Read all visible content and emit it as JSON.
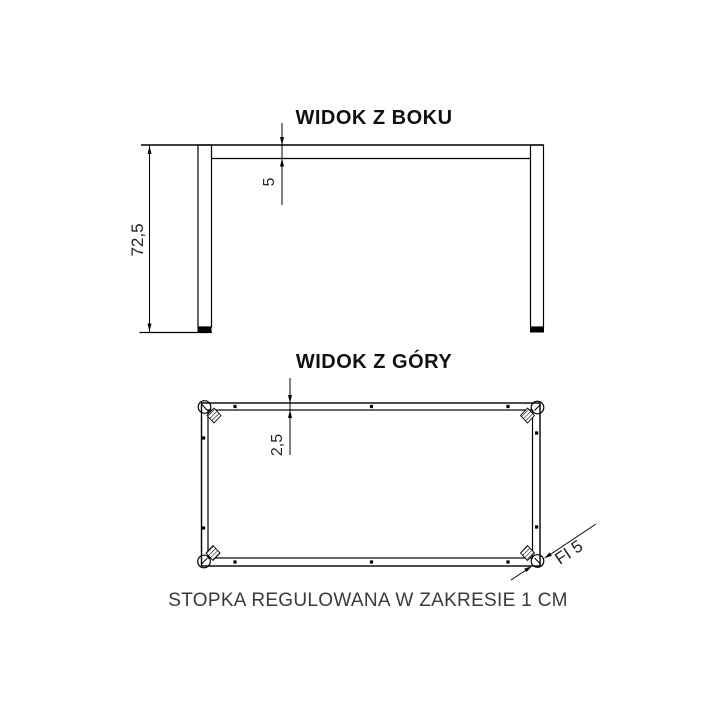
{
  "side_view": {
    "title": "WIDOK Z BOKU",
    "height_dim_label": "72,5",
    "rail_height_dim_label": "5"
  },
  "top_view": {
    "title": "WIDOK Z GÓRY",
    "rail_depth_dim_label": "2,5",
    "foot_diameter_label": "FI 5"
  },
  "caption": "STOPKA REGULOWANA W ZAKRESIE 1 CM",
  "colors": {
    "line": "#000000",
    "title_text": "#111111",
    "dim_text": "#222222",
    "caption_text": "#3a3a3a",
    "background": "#ffffff"
  }
}
